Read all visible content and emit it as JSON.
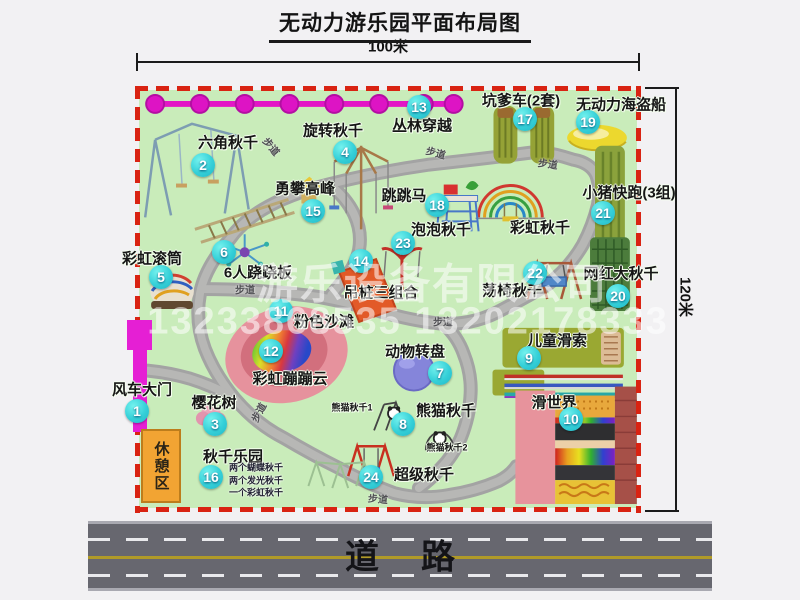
{
  "title": "无动力游乐园平面布局图",
  "dimensions": {
    "width_label": "100米",
    "height_label": "120米"
  },
  "road": {
    "label": "道路"
  },
  "watermark": {
    "company": "游乐设备有限公司",
    "phone": "13233868535 13202178333"
  },
  "rest_area": {
    "label": "休憩区"
  },
  "map": {
    "path_label_text": "步道",
    "attractions": [
      {
        "num": "1",
        "label": "风车大门",
        "lx": 142,
        "ly": 389,
        "bx": 137,
        "by": 411
      },
      {
        "num": "2",
        "label": "六角秋千",
        "lx": 228,
        "ly": 142,
        "bx": 203,
        "by": 165
      },
      {
        "num": "3",
        "label": "樱花树",
        "lx": 214,
        "ly": 402,
        "bx": 215,
        "by": 424
      },
      {
        "num": "4",
        "label": "旋转秋千",
        "lx": 333,
        "ly": 130,
        "bx": 345,
        "by": 152
      },
      {
        "num": "5",
        "label": "彩虹滚筒",
        "lx": 152,
        "ly": 258,
        "bx": 161,
        "by": 277
      },
      {
        "num": "6",
        "label": "6人跷跷板",
        "lx": 258,
        "ly": 272,
        "bx": 224,
        "by": 252
      },
      {
        "num": "7",
        "label": "动物转盘",
        "lx": 415,
        "ly": 351,
        "bx": 440,
        "by": 373
      },
      {
        "num": "8",
        "label": "熊猫秋千",
        "lx": 446,
        "ly": 410,
        "bx": 403,
        "by": 424
      },
      {
        "num": "9",
        "label": "儿童滑索",
        "lx": 557,
        "ly": 340,
        "bx": 529,
        "by": 358
      },
      {
        "num": "10",
        "label": "滑世界",
        "lx": 554,
        "ly": 402,
        "bx": 571,
        "by": 419
      },
      {
        "num": "11",
        "label": "粉色沙滩",
        "lx": 324,
        "ly": 321,
        "bx": 281,
        "by": 311
      },
      {
        "num": "12",
        "label": "彩虹蹦蹦云",
        "lx": 290,
        "ly": 378,
        "bx": 271,
        "by": 351
      },
      {
        "num": "13",
        "label": "丛林穿越",
        "lx": 422,
        "ly": 125,
        "bx": 419,
        "by": 107
      },
      {
        "num": "14",
        "label": "吊桩三组合",
        "lx": 381,
        "ly": 292,
        "bx": 361,
        "by": 261
      },
      {
        "num": "15",
        "label": "勇攀高峰",
        "lx": 305,
        "ly": 188,
        "bx": 313,
        "by": 211
      },
      {
        "num": "16",
        "label": "秋千乐园",
        "lx": 233,
        "ly": 456,
        "bx": 211,
        "by": 477,
        "subs": [
          "两个蝴蝶秋千",
          "两个发光秋千",
          "一个彩虹秋千"
        ],
        "subs_x": 229,
        "subs_y": 467
      },
      {
        "num": "17",
        "label": "坑爹车(2套)",
        "lx": 521,
        "ly": 100,
        "bx": 525,
        "by": 119
      },
      {
        "num": "18",
        "label": "跳跳马",
        "lx": 404,
        "ly": 195,
        "bx": 437,
        "by": 205
      },
      {
        "num": "19",
        "label": "无动力海盗船",
        "lx": 621,
        "ly": 104,
        "bx": 588,
        "by": 122
      },
      {
        "num": "20",
        "label": "网红大秋千",
        "lx": 621,
        "ly": 273,
        "bx": 618,
        "by": 296
      },
      {
        "num": "21",
        "label": "小猪快跑(3组)",
        "lx": 629,
        "ly": 192,
        "bx": 603,
        "by": 213
      },
      {
        "num": "22",
        "label": "荡椅秋千",
        "lx": 512,
        "ly": 290,
        "bx": 535,
        "by": 273
      },
      {
        "num": "23",
        "label": "泡泡秋千",
        "lx": 441,
        "ly": 229,
        "bx": 403,
        "by": 243
      },
      {
        "num": "24",
        "label": "超级秋千",
        "lx": 424,
        "ly": 474,
        "bx": 371,
        "by": 477
      }
    ],
    "other_labels": [
      {
        "text": "彩虹秋千",
        "x": 540,
        "y": 227,
        "size": 15,
        "name": "rainbow-swing-label"
      },
      {
        "text": "熊猫秋千1",
        "x": 352,
        "y": 407,
        "size": 9,
        "name": "panda-swing-1-label"
      },
      {
        "text": "熊猫秋千2",
        "x": 447,
        "y": 447,
        "size": 9,
        "name": "panda-swing-2-label"
      }
    ],
    "path_labels": [
      {
        "x": 272,
        "y": 146,
        "r": 50
      },
      {
        "x": 436,
        "y": 152,
        "r": 15
      },
      {
        "x": 548,
        "y": 163,
        "r": 8
      },
      {
        "x": 245,
        "y": 289,
        "r": 0
      },
      {
        "x": 443,
        "y": 321,
        "r": 0
      },
      {
        "x": 258,
        "y": 412,
        "r": -62
      },
      {
        "x": 378,
        "y": 498,
        "r": 5
      }
    ],
    "icons": [
      "windmill-gate",
      "hexagon-swing",
      "cherry-tree",
      "rotating-swing",
      "rainbow-roller",
      "six-person-seesaw",
      "animal-turntable",
      "panda-swing",
      "kids-zipline",
      "slide-world",
      "pink-beach",
      "rainbow-bounce-cloud",
      "jungle-crossing-chain",
      "hanging-pile-combo",
      "climbing-peak",
      "swing-park",
      "kengdie-cart",
      "jumping-horse",
      "pirate-ship",
      "big-net-swing",
      "pig-run-track",
      "swing-chair",
      "bubble-swing",
      "super-swing",
      "rainbow-swing"
    ]
  }
}
